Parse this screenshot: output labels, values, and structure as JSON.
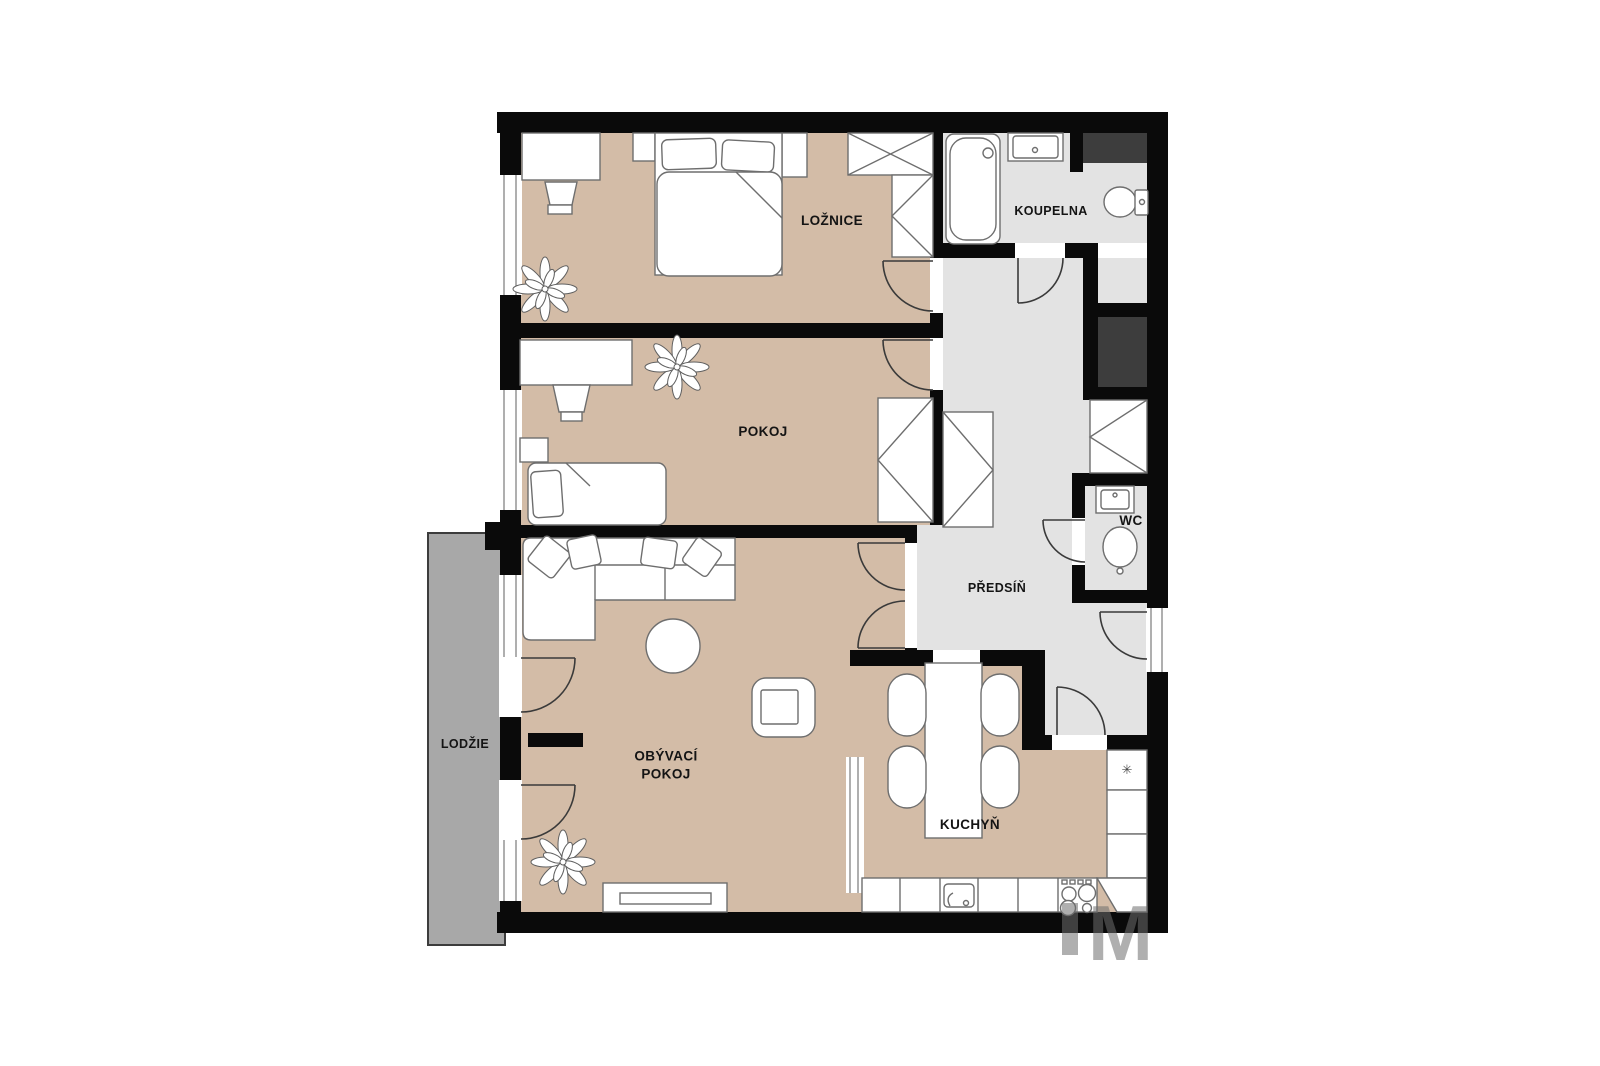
{
  "plan_title": "Apartment floor plan",
  "rooms": {
    "loznice": {
      "label": "LOŽNICE"
    },
    "pokoj": {
      "label": "POKOJ"
    },
    "obyvaci_pokoj": {
      "label": "OBÝVACÍ POKOJ"
    },
    "kuchyn": {
      "label": "KUCHYŇ"
    },
    "predsin": {
      "label": "PŘEDSÍŇ"
    },
    "koupelna": {
      "label": "KOUPELNA"
    },
    "wc": {
      "label": "WC"
    },
    "lodzie": {
      "label": "LODŽIE"
    }
  },
  "icons": {
    "fridge_snowflake": "✳"
  },
  "watermark": "M",
  "colors": {
    "wall": "#0a0a0a",
    "floor_beige": "#d3bca7",
    "floor_gray": "#e3e3e3",
    "loggia_gray": "#a8a8a8",
    "shaft_dark": "#3d3d3d",
    "furniture_stroke": "#6e6e6e"
  }
}
